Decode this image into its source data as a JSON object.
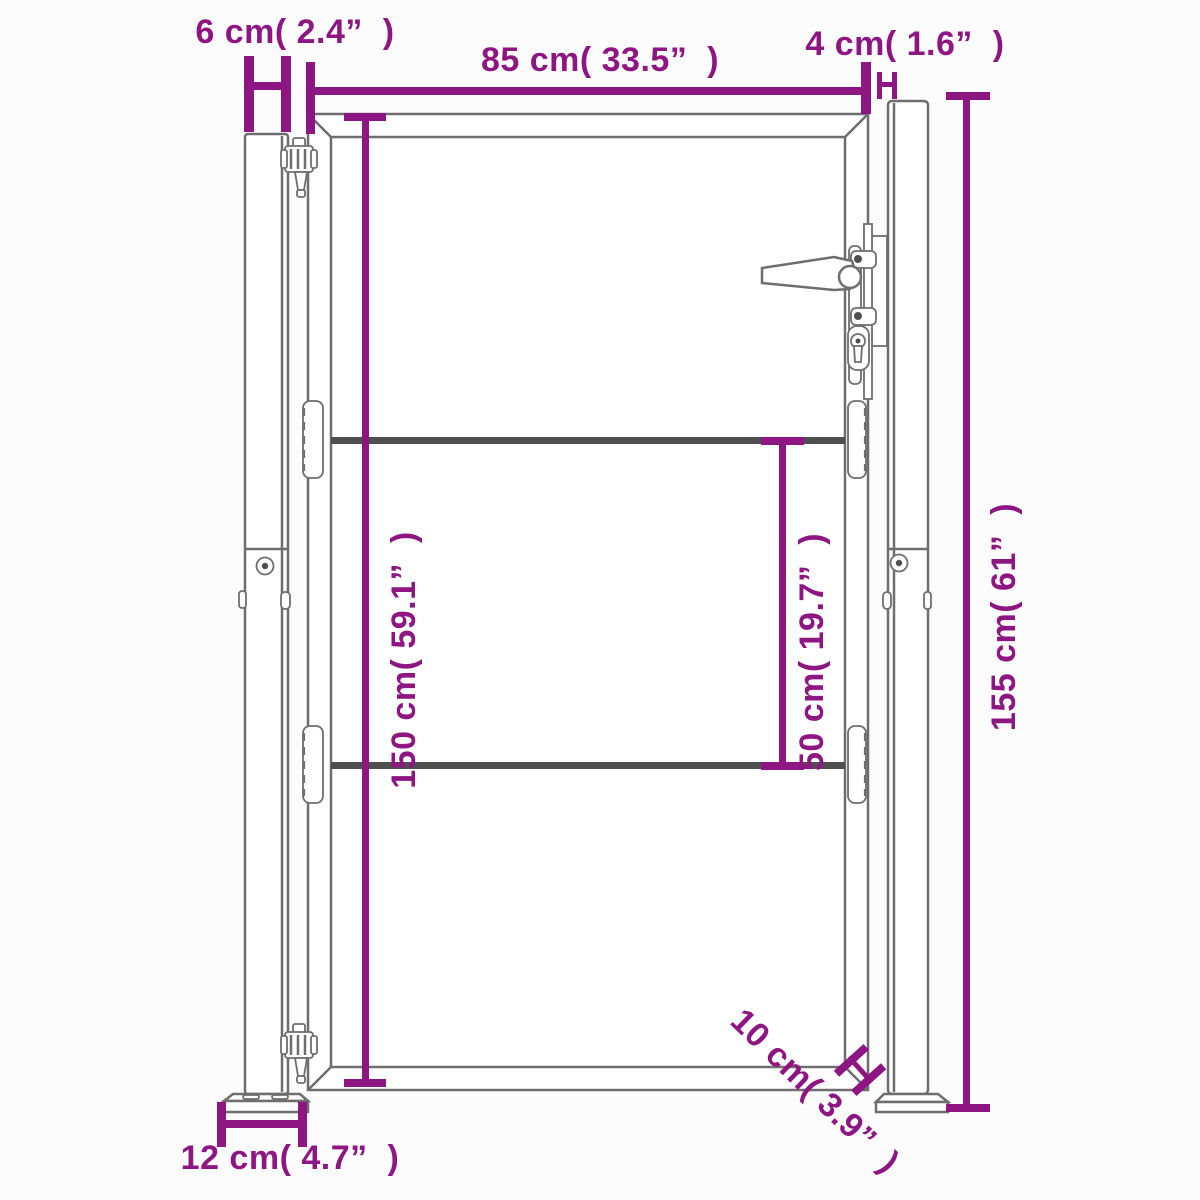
{
  "title": "Garden gate dimension diagram",
  "colors": {
    "dimension": "#8E1683",
    "outline": "#6e6e6e",
    "rail": "#4f4f4f",
    "background": "#fcfcfc"
  },
  "dimensions": {
    "post_width": {
      "label": "6 cm( 2.4”  )"
    },
    "gate_width": {
      "label": "85 cm( 33.5”  )"
    },
    "gap_gate_post": {
      "label": "4 cm( 1.6”  )"
    },
    "post_height": {
      "label": "155 cm( 61”  )"
    },
    "gate_height": {
      "label": "150 cm( 59.1”  )"
    },
    "rail_spacing": {
      "label": "50 cm( 19.7”  )"
    },
    "base_plate_width": {
      "label": "12 cm( 4.7”  )"
    },
    "ground_clearance": {
      "label": "10 cm( 3.9”  )"
    }
  }
}
